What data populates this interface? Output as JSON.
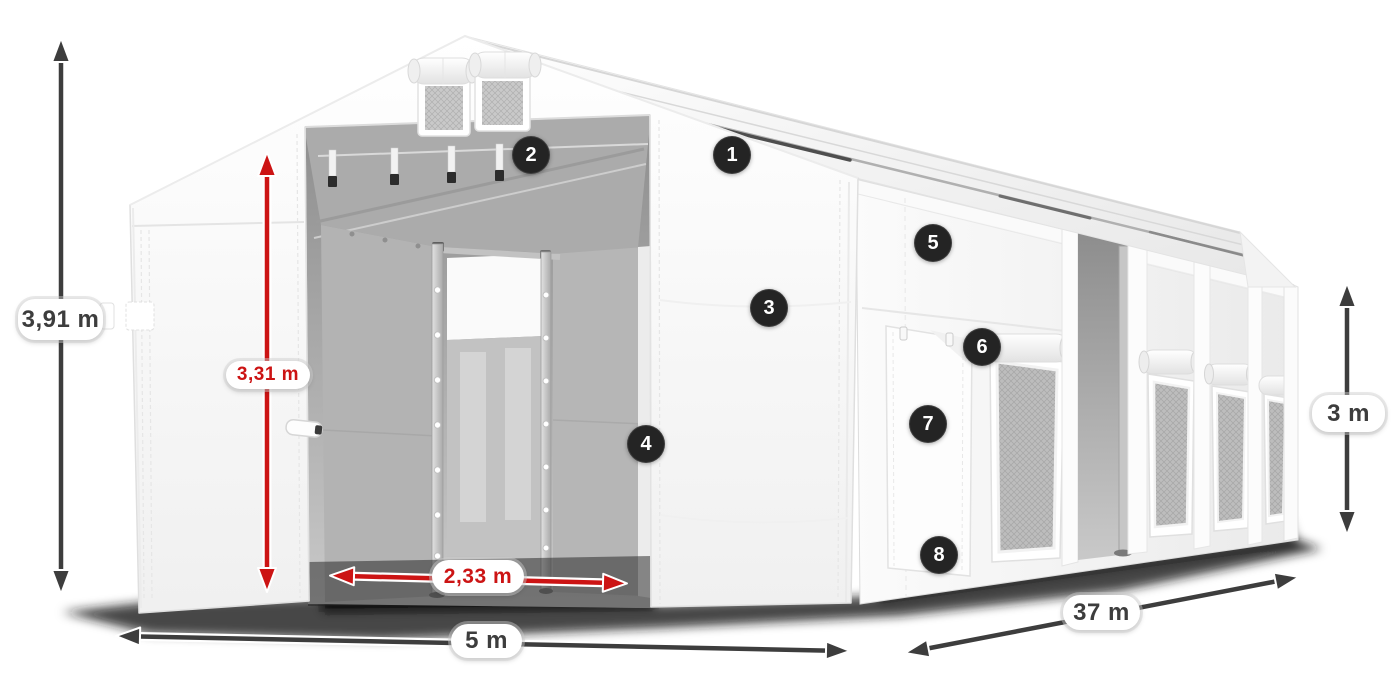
{
  "colors": {
    "background": "#ffffff",
    "dimension_red": "#cc1414",
    "dimension_dark": "#3d3d3d",
    "badge_background": "#242424",
    "badge_text": "#ffffff",
    "tent_white": "#f7f7f7",
    "interior_gray": "#a9a9a9"
  },
  "dimensions": {
    "total_height": {
      "label": "3,91 m"
    },
    "door_height": {
      "label": "3,31 m"
    },
    "door_width": {
      "label": "2,33 m"
    },
    "front_width": {
      "label": "5 m"
    },
    "side_length": {
      "label": "37 m"
    },
    "side_height": {
      "label": "3 m"
    }
  },
  "callouts": [
    {
      "number": "1"
    },
    {
      "number": "2"
    },
    {
      "number": "3"
    },
    {
      "number": "4"
    },
    {
      "number": "5"
    },
    {
      "number": "6"
    },
    {
      "number": "7"
    },
    {
      "number": "8"
    }
  ]
}
